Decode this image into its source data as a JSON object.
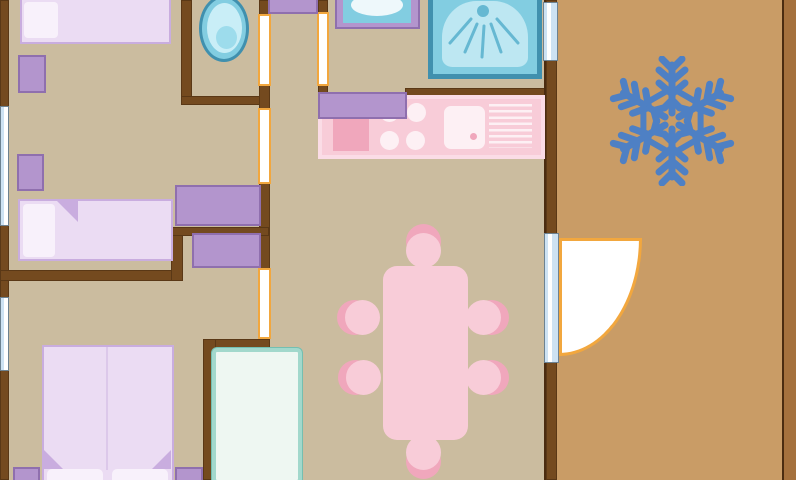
{
  "plan": {
    "type": "floor-plan",
    "icons": [
      "snowflake-icon"
    ],
    "rooms": [
      "bedroom-top-left",
      "bedroom-left",
      "master-bedroom",
      "toilet-room",
      "bathroom",
      "kitchen",
      "dining-area",
      "hallway",
      "terrace"
    ],
    "furniture": [
      "single-bed",
      "single-bed",
      "double-bed",
      "nightstands",
      "wardrobes",
      "toilet",
      "washbasin",
      "shower",
      "kitchen-counter",
      "cooktop",
      "kitchen-sink",
      "draining-board",
      "dining-table",
      "six-chairs",
      "tall-cabinet",
      "entrance-door",
      "windows"
    ],
    "colors": {
      "floor": "#cbbc9f",
      "terrace_floor": "#c99c66",
      "terrace_rail": "#a5713d",
      "wall": "#744a1f",
      "wall_dark": "#4b2c10",
      "door_accent": "#f2a73e",
      "window_blue": "#cde2f3",
      "window_edge": "#6d8291",
      "fixture_blue": "#82cde1",
      "fixture_blue_dark": "#4090ae",
      "fixture_blue_light": "#bde7f2",
      "fixture_blue_pale": "#c9eef7",
      "fixture_blue_mid": "#9ddcec",
      "spray": "#66b8d2",
      "purple": "#b395cd",
      "purple_dark": "#8f6fae",
      "bed_fill": "#ebdcf3",
      "bed_border": "#c9addf",
      "bed_divider": "#dcc8ea",
      "pillow": "#f8f1fb",
      "pink": "#f8ccd8",
      "pink_dark": "#f0a7bc",
      "pink_light": "#fdf0f4",
      "pink_border": "#fbdce6",
      "teal_border": "#a2d8cc",
      "teal_edge": "#74bfb1",
      "teal_fill": "#eef7f2",
      "snowflake": "#4e80c4"
    }
  }
}
